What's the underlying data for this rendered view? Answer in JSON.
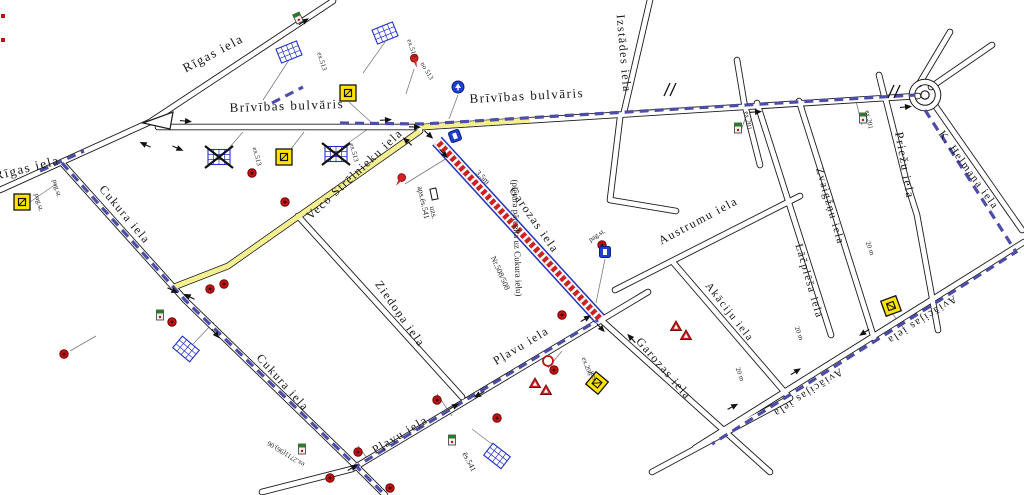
{
  "map": {
    "colors": {
      "road": "#1a1a1a",
      "detour_dash": "#4d4da8",
      "route_highlight": "#f4ef8f",
      "closed_red": "#cc2222",
      "closed_edge": "#2233bb",
      "sign_blue": "#2230c8",
      "sign_yellow": "#ffe400",
      "sign_red": "#c11212"
    },
    "street_labels": [
      {
        "text": "Rīgas iela",
        "x": 215,
        "y": 57,
        "rot": -28,
        "size": 13
      },
      {
        "text": "Rīgas iela",
        "x": 28,
        "y": 172,
        "rot": -14,
        "size": 13
      },
      {
        "text": "Brīvības bulvāris",
        "x": 287,
        "y": 110,
        "rot": -2,
        "size": 13
      },
      {
        "text": "Brīvības bulvāris",
        "x": 527,
        "y": 100,
        "rot": -3,
        "size": 13
      },
      {
        "text": "Izstādes iela",
        "x": 620,
        "y": 54,
        "rot": 85,
        "size": 12
      },
      {
        "text": "Priežu iela",
        "x": 901,
        "y": 166,
        "rot": 80,
        "size": 12
      },
      {
        "text": "K. Helmaņa iela",
        "x": 966,
        "y": 172,
        "rot": 54,
        "size": 11,
        "color": "#3a3aa0"
      },
      {
        "text": "Zvaigžņu iela",
        "x": 827,
        "y": 207,
        "rot": 74,
        "size": 11
      },
      {
        "text": "Lāčplēša iela",
        "x": 806,
        "y": 282,
        "rot": 74,
        "size": 11
      },
      {
        "text": "Austrumu iela",
        "x": 700,
        "y": 224,
        "rot": -28,
        "size": 12
      },
      {
        "text": "Akāciju iela",
        "x": 727,
        "y": 314,
        "rot": 52,
        "size": 11
      },
      {
        "text": "Aviācijas iela",
        "x": 920,
        "y": 317,
        "rot": 147,
        "size": 11
      },
      {
        "text": "Aviācijas iela",
        "x": 806,
        "y": 390,
        "rot": 147,
        "size": 11
      },
      {
        "text": "Veco Strēlnieku iela",
        "x": 357,
        "y": 177,
        "rot": -43,
        "size": 12
      },
      {
        "text": "Cukura iela",
        "x": 122,
        "y": 217,
        "rot": 50,
        "size": 12
      },
      {
        "text": "Cukura iela",
        "x": 280,
        "y": 385,
        "rot": 48,
        "size": 12
      },
      {
        "text": "Ziedoņa iela",
        "x": 397,
        "y": 316,
        "rot": 55,
        "size": 12
      },
      {
        "text": "Pļavu iela",
        "x": 402,
        "y": 438,
        "rot": -31,
        "size": 12
      },
      {
        "text": "Pļavu iela",
        "x": 523,
        "y": 349,
        "rot": -31,
        "size": 12
      },
      {
        "text": "Garozas iela",
        "x": 531,
        "y": 222,
        "rot": 55,
        "size": 12
      },
      {
        "text": "Garozas iela",
        "x": 661,
        "y": 371,
        "rot": 49,
        "size": 12
      }
    ],
    "small_labels": [
      {
        "text": "(pietura pārcelta uz Cukura ielu)",
        "x": 514,
        "y": 238,
        "rot": 88,
        "size": 9
      },
      {
        "text": "aps.ēs.541",
        "x": 421,
        "y": 203,
        "rot": 78,
        "size": 8
      },
      {
        "text": "uzs.",
        "x": 431,
        "y": 213,
        "rot": 78,
        "size": 8
      },
      {
        "text": "3,5m",
        "x": 481,
        "y": 179,
        "rot": 45,
        "size": 8
      },
      {
        "text": "Nr.508/508",
        "x": 498,
        "y": 274,
        "rot": 66,
        "size": 8
      },
      {
        "text": "pag.st.",
        "x": 37,
        "y": 203,
        "rot": 75,
        "size": 7
      },
      {
        "text": "pag.st.",
        "x": 55,
        "y": 189,
        "rot": 75,
        "size": 7
      },
      {
        "text": "pag.st.",
        "x": 598,
        "y": 237,
        "rot": -33,
        "size": 7
      },
      {
        "text": "ex.201",
        "x": 746,
        "y": 121,
        "rot": 80,
        "size": 7
      },
      {
        "text": "ex.201",
        "x": 867,
        "y": 120,
        "rot": 80,
        "size": 7
      },
      {
        "text": "ēs.541",
        "x": 467,
        "y": 463,
        "rot": 62,
        "size": 8
      },
      {
        "text": "ex.206",
        "x": 585,
        "y": 367,
        "rot": 70,
        "size": 7
      },
      {
        "text": "uzs.",
        "x": 592,
        "y": 377,
        "rot": 70,
        "size": 7
      },
      {
        "text": "ex.2711(96).06",
        "x": 287,
        "y": 452,
        "rot": 212,
        "size": 7
      },
      {
        "text": "ex.513",
        "x": 320,
        "y": 62,
        "rot": 72,
        "size": 7
      },
      {
        "text": "ex.513",
        "x": 410,
        "y": 49,
        "rot": 72,
        "size": 7
      },
      {
        "text": "no 513",
        "x": 425,
        "y": 72,
        "rot": 60,
        "size": 7
      },
      {
        "text": "ex.513",
        "x": 255,
        "y": 157,
        "rot": 75,
        "size": 7
      },
      {
        "text": "ex.513",
        "x": 352,
        "y": 153,
        "rot": 75,
        "size": 7
      },
      {
        "text": "20 m",
        "x": 797,
        "y": 334,
        "rot": 70,
        "size": 7
      },
      {
        "text": "20 m",
        "x": 868,
        "y": 249,
        "rot": 70,
        "size": 7
      },
      {
        "text": "20 m",
        "x": 738,
        "y": 375,
        "rot": 70,
        "size": 7
      }
    ],
    "signs": [
      {
        "type": "bus_table",
        "x": 289,
        "y": 52,
        "rot": -22
      },
      {
        "type": "bus_table",
        "x": 385,
        "y": 33,
        "rot": -22
      },
      {
        "type": "bus_table",
        "x": 186,
        "y": 349,
        "rot": 40
      },
      {
        "type": "bus_table",
        "x": 497,
        "y": 456,
        "rot": 38
      },
      {
        "type": "bus_table_crossed",
        "x": 219,
        "y": 157,
        "rot": 0
      },
      {
        "type": "bus_table_crossed",
        "x": 336,
        "y": 154,
        "rot": 0
      },
      {
        "type": "yellow_sign",
        "x": 348,
        "y": 93,
        "rot": 0
      },
      {
        "type": "yellow_sign",
        "x": 284,
        "y": 157,
        "rot": 0
      },
      {
        "type": "yellow_sign",
        "x": 22,
        "y": 202,
        "rot": 0
      },
      {
        "type": "yellow_sign",
        "x": 597,
        "y": 383,
        "rot": 40
      },
      {
        "type": "yellow_sign",
        "x": 891,
        "y": 306,
        "rot": 70
      },
      {
        "type": "red_circle",
        "x": 252,
        "y": 173
      },
      {
        "type": "red_circle",
        "x": 285,
        "y": 202
      },
      {
        "type": "red_circle",
        "x": 210,
        "y": 289
      },
      {
        "type": "red_circle",
        "x": 224,
        "y": 284
      },
      {
        "type": "red_circle",
        "x": 172,
        "y": 322
      },
      {
        "type": "red_circle",
        "x": 64,
        "y": 354
      },
      {
        "type": "red_circle",
        "x": 358,
        "y": 452
      },
      {
        "type": "red_circle",
        "x": 390,
        "y": 488
      },
      {
        "type": "red_circle",
        "x": 437,
        "y": 400
      },
      {
        "type": "red_circle",
        "x": 497,
        "y": 418
      },
      {
        "type": "red_circle",
        "x": 554,
        "y": 370
      },
      {
        "type": "red_circle",
        "x": 562,
        "y": 315
      },
      {
        "type": "red_circle",
        "x": 602,
        "y": 245
      },
      {
        "type": "red_circle",
        "x": 330,
        "y": 478
      },
      {
        "type": "red_ring",
        "x": 548,
        "y": 361
      },
      {
        "type": "red_pin",
        "x": 415,
        "y": 61,
        "rot": -15
      },
      {
        "type": "red_pin",
        "x": 400,
        "y": 180,
        "rot": 35
      },
      {
        "type": "red_triangle",
        "x": 676,
        "y": 327
      },
      {
        "type": "red_triangle",
        "x": 686,
        "y": 336
      },
      {
        "type": "red_triangle",
        "x": 535,
        "y": 384
      },
      {
        "type": "red_triangle",
        "x": 546,
        "y": 391
      },
      {
        "type": "blue_circle",
        "x": 458,
        "y": 87
      },
      {
        "type": "blue_square",
        "x": 455,
        "y": 136,
        "rot": -20
      },
      {
        "type": "blue_square",
        "x": 605,
        "y": 252,
        "rot": 0
      },
      {
        "type": "mini_sign",
        "x": 738,
        "y": 128
      },
      {
        "type": "mini_sign",
        "x": 863,
        "y": 118
      },
      {
        "type": "mini_sign",
        "x": 452,
        "y": 440
      },
      {
        "type": "mini_sign",
        "x": 160,
        "y": 315
      },
      {
        "type": "mini_sign",
        "x": 298,
        "y": 18,
        "rot": -25
      },
      {
        "type": "mini_sign",
        "x": 302,
        "y": 449
      },
      {
        "type": "uzs_box",
        "x": 434,
        "y": 194,
        "rot": 78
      },
      {
        "type": "red_sq",
        "x": 3,
        "y": 16
      },
      {
        "type": "red_sq",
        "x": 3,
        "y": 40
      },
      {
        "type": "tick",
        "x": 672,
        "y": 90
      },
      {
        "type": "tick",
        "x": 896,
        "y": 92
      }
    ],
    "arrows": [
      {
        "x": 146,
        "y": 145,
        "rot": 205
      },
      {
        "x": 177,
        "y": 148,
        "rot": 23
      },
      {
        "x": 185,
        "y": 121,
        "rot": 5
      },
      {
        "x": 303,
        "y": 22,
        "rot": -33
      },
      {
        "x": 385,
        "y": 120,
        "rot": -4
      },
      {
        "x": 414,
        "y": 127,
        "rot": 2
      },
      {
        "x": 428,
        "y": 134,
        "rot": 43
      },
      {
        "x": 443,
        "y": 153,
        "rot": 47
      },
      {
        "x": 408,
        "y": 142,
        "rot": 222
      },
      {
        "x": 172,
        "y": 290,
        "rot": 25
      },
      {
        "x": 190,
        "y": 297,
        "rot": 207
      },
      {
        "x": 215,
        "y": 333,
        "rot": 50
      },
      {
        "x": 352,
        "y": 468,
        "rot": -31
      },
      {
        "x": 453,
        "y": 407,
        "rot": -31
      },
      {
        "x": 480,
        "y": 394,
        "rot": 149
      },
      {
        "x": 585,
        "y": 319,
        "rot": -31
      },
      {
        "x": 600,
        "y": 327,
        "rot": 47
      },
      {
        "x": 632,
        "y": 339,
        "rot": 227
      },
      {
        "x": 732,
        "y": 407,
        "rot": -28
      },
      {
        "x": 755,
        "y": 112,
        "rot": -4
      },
      {
        "x": 905,
        "y": 107,
        "rot": -5
      },
      {
        "x": 865,
        "y": 332,
        "rot": 147
      },
      {
        "x": 795,
        "y": 372,
        "rot": -33
      }
    ],
    "leaders": [
      [
        289,
        60,
        263,
        100
      ],
      [
        385,
        42,
        363,
        73
      ],
      [
        414,
        69,
        406,
        94
      ],
      [
        458,
        95,
        449,
        119
      ],
      [
        349,
        102,
        373,
        124
      ],
      [
        229,
        148,
        243,
        132
      ],
      [
        344,
        146,
        368,
        129
      ],
      [
        291,
        149,
        304,
        132
      ],
      [
        30,
        202,
        56,
        184
      ],
      [
        70,
        351,
        96,
        336
      ],
      [
        193,
        344,
        214,
        322
      ],
      [
        497,
        448,
        472,
        429
      ],
      [
        605,
        259,
        596,
        303
      ],
      [
        740,
        133,
        749,
        108
      ],
      [
        862,
        125,
        856,
        101
      ],
      [
        548,
        368,
        562,
        351
      ],
      [
        405,
        184,
        447,
        158
      ],
      [
        437,
        394,
        452,
        416
      ],
      [
        358,
        446,
        370,
        462
      ],
      [
        891,
        312,
        905,
        330
      ]
    ]
  }
}
